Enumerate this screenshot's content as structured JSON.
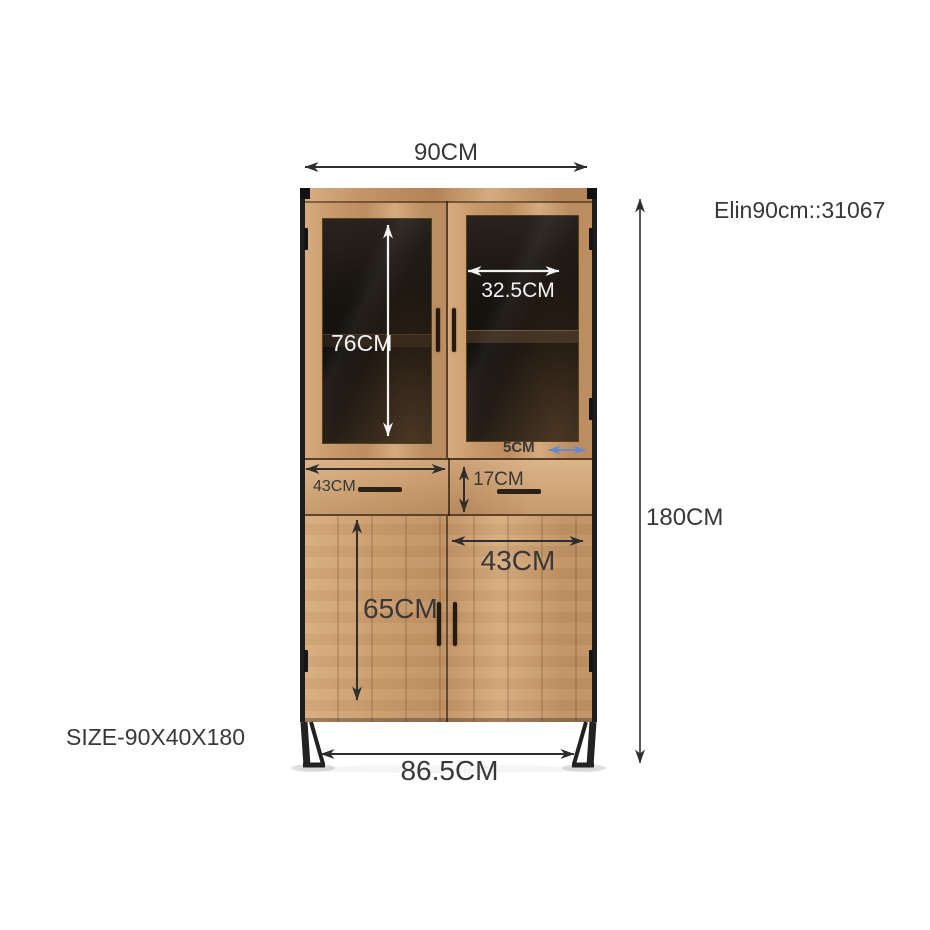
{
  "title": "Cabinet dimension diagram",
  "product": {
    "model_code": "Elin90cm::31067",
    "size_code": "SIZE-90X40X180"
  },
  "dimensions": {
    "overall_width": "90CM",
    "overall_height": "180CM",
    "base_width": "86.5CM",
    "glass_door_height": "76CM",
    "glass_door_width": "32.5CM",
    "frame_offset": "5CM",
    "drawer_width": "43CM",
    "drawer_height": "17CM",
    "lower_door_width": "43CM",
    "lower_door_height": "65CM"
  },
  "colors": {
    "background": "#ffffff",
    "wood": "#c9996a",
    "metal_frame": "#1e1e1e",
    "glass": "#17130f",
    "annotation_dark": "#383838",
    "annotation_light": "#f4f4f4",
    "accent_blue": "#6488cf"
  }
}
